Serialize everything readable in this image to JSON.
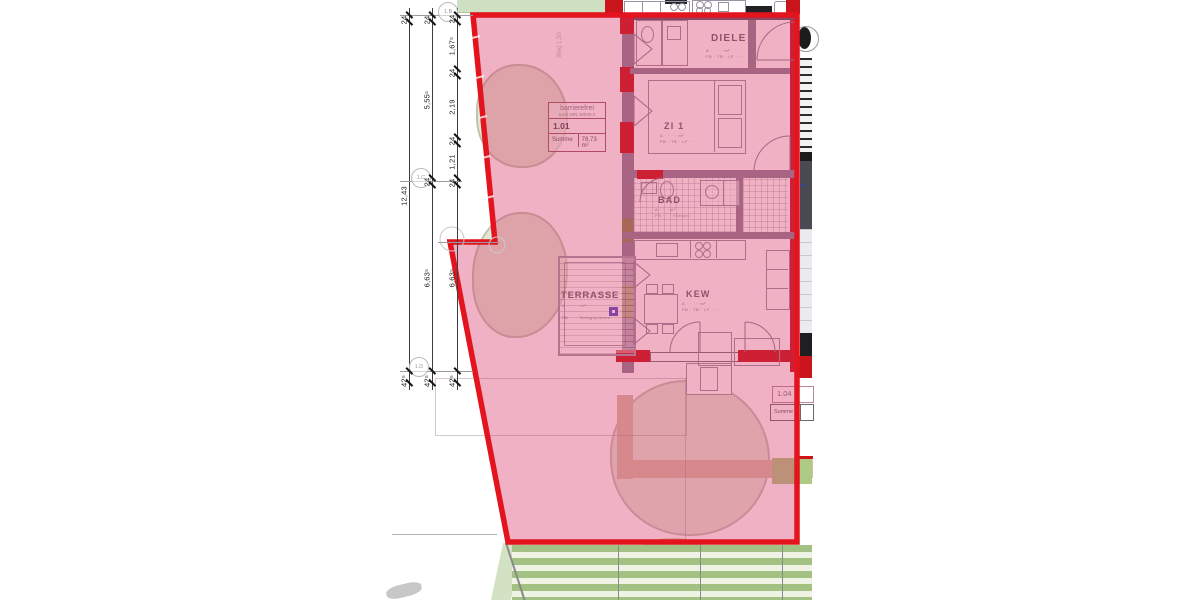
{
  "dimensions": {
    "chain_outer": [
      "24",
      "12,43",
      "42⁵"
    ],
    "chain_mid": [
      "24",
      "5,55⁵",
      "24",
      "6,63⁵",
      "42⁵"
    ],
    "chain_inner": [
      "24",
      "1,67⁵",
      "24",
      "2,19",
      "24",
      "1,21",
      "24",
      "6,63⁵",
      "42⁵"
    ]
  },
  "grid_bubbles": [
    "1.B",
    "1.C",
    "1.D"
  ],
  "rooms": {
    "diele": {
      "name": "DIELE",
      "line_a": "A · · · · m²",
      "line_fb": "FB · TB · LF · · ·"
    },
    "zi1": {
      "name": "ZI 1",
      "line_a": "A · · · · m²",
      "line_fb": "FB · TB · LF · · ·"
    },
    "bad": {
      "name": "BAD",
      "line_a": "A · · · m²",
      "line_fb": "FB · · · Fliesen"
    },
    "kew": {
      "name": "KEW",
      "line_a": "A · · · · m²",
      "line_fb": "FB · TB · LF · · ·"
    },
    "terrasse": {
      "name": "TERRASSE",
      "line_a": "A · · · · m²",
      "line_b": "· · · · · · ·",
      "line_fb": "FB · · · Belagsplatten"
    }
  },
  "unit_101": {
    "note": "barrierefrei",
    "norm": "nach DIN 18040-2",
    "number": "1.01",
    "sum_label": "Summe",
    "sum_value": "78,73 m²"
  },
  "unit_104": {
    "number": "1.04",
    "sum_label": "Summe"
  },
  "site_label": "Weg 1,50",
  "colors": {
    "overlay_stroke": "#e3141d",
    "overlay_fill": "rgba(214,50,98,0.38)",
    "new_wall_red": "#c9151b"
  }
}
